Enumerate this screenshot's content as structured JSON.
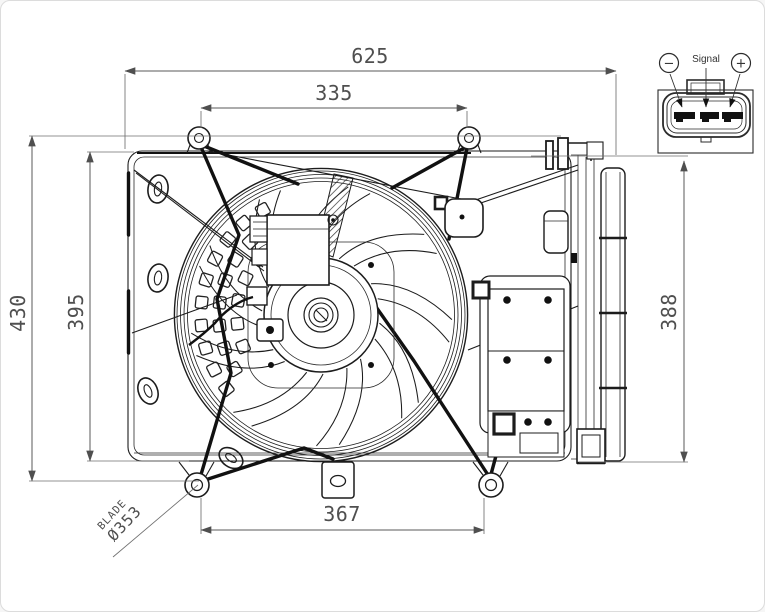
{
  "page": {
    "background": "#ffffff",
    "border_color": "#dcdcdc"
  },
  "drawing": {
    "title": "engine-cooling-fan-assembly-dimensioned-drawing",
    "line_color": "#1c1c1c",
    "dim_color": "#585858",
    "dimensions": {
      "overall_width": "625",
      "upper_mount_span": "335",
      "overall_height": "430",
      "shroud_height": "395",
      "side_profile_height": "388",
      "lower_mount_span": "367",
      "blade_word": "BLADE",
      "blade_diameter": "Ø353"
    },
    "connector": {
      "negative_symbol": "−",
      "signal_label": "Signal",
      "positive_symbol": "+"
    }
  }
}
